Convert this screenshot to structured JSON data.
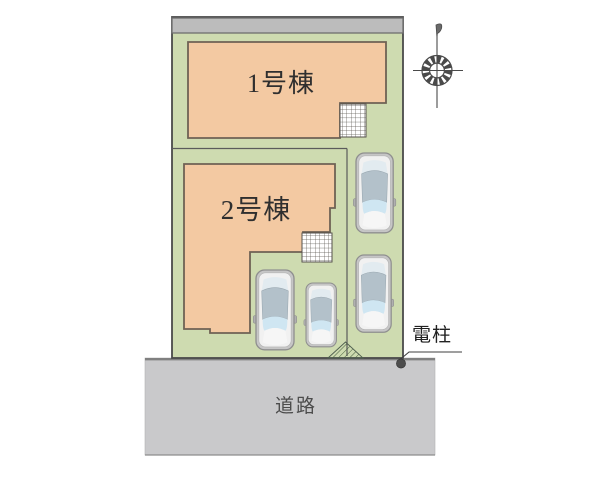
{
  "site_plan": {
    "buildings": [
      {
        "label": "1号棟"
      },
      {
        "label": "2号棟"
      }
    ],
    "road": {
      "label": "道路"
    },
    "utility_pole": {
      "label": "電柱"
    },
    "parking": {
      "car_count": 4
    },
    "compass": {
      "name": "north-indicator"
    }
  },
  "colors": {
    "plot_green": "#cedbb0",
    "building_fill": "#f3c9a2",
    "building_border": "#6f6254",
    "neighbor_wall_gray": "#bcbcbc",
    "road_gray": "#c9c9cb",
    "line_dark": "#4a4a4a",
    "car_body": "#c6c6c6",
    "car_roof": "#b3c1ca",
    "car_glass": "#cfe6f2",
    "pole_dot": "#4d4d4d"
  }
}
